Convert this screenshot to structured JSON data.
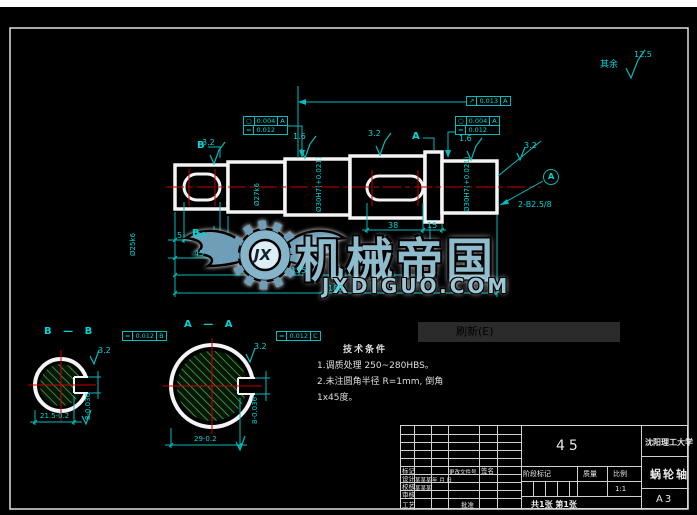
{
  "menu": {
    "refresh": "刷新(E)"
  },
  "watermark": {
    "brand": "机械帝国",
    "domain": "JXDIGUO.COM",
    "monogram": "JX"
  },
  "notes": {
    "title": "技术条件",
    "line1": "1.调质处理 250~280HBS。",
    "line2": "2.未注圆角半径 R=1mm, 倒角",
    "line3": "1x45度。"
  },
  "general_roughness": {
    "label": "其余",
    "value": "12.5"
  },
  "dims": {
    "rough_seg1": "3.2",
    "rough_seg3": "1.6",
    "rough_seg4": "3.2",
    "rough_seg5": "1.6",
    "rough_chamfer": "3.2",
    "dia_seg1": "Ø25k6",
    "dia_seg2": "Ø27k6",
    "dia_seg3": "Ø30H7(+0.021)",
    "dia_seg5": "Ø30H7(+0.021)",
    "len_5": "5",
    "len_28": "28",
    "len_45": "45",
    "len_38": "38",
    "len_15": "15",
    "len_155": "155",
    "len_188": "188",
    "center_holes": "2-B2.5/8",
    "cut_b_top": "B",
    "cut_b_bottom": "B",
    "cut_a_top": "A",
    "datum_a": "A"
  },
  "frames": {
    "f1_sym1": "○",
    "f1_val1": "0.004",
    "f1_ref1": "A",
    "f1_sym2": "=",
    "f1_val2": "0.012",
    "f2_sym": "↗",
    "f2_val": "0.013",
    "f2_ref": "A",
    "f3_sym1": "○",
    "f3_val1": "0.004",
    "f3_ref1": "A",
    "f3_sym2": "=",
    "f3_val2": "0.012",
    "fb_sym": "=",
    "fb_val": "0.012",
    "fb_ref": "B",
    "fc_sym": "=",
    "fc_val": "0.012",
    "fc_ref": "C"
  },
  "section_b": {
    "title": "B — B",
    "width": "21.5-0.2",
    "slot": "8-0.036",
    "rough": "3.2"
  },
  "section_a": {
    "title": "A — A",
    "width": "29-0.2",
    "slot": "8-0.036",
    "rough": "3.2"
  },
  "title_block": {
    "material": "45",
    "university": "沈阳理工大学",
    "part_name": "蜗轮轴",
    "paper": "A3",
    "stage": "阶段标记",
    "mass": "质量",
    "scale": "比例",
    "scale_val": "1:1",
    "sheets": "共1张 第1张",
    "r_mark": "标记",
    "r_change": "更改文件号",
    "r_sign": "签名",
    "r_design": "设计",
    "r_design_name": "某某某",
    "r_design_date": "年 月 日",
    "r_check": "校核",
    "r_check_name": "某某某",
    "r_review": "审核",
    "r_process": "工艺",
    "r_approve": "批准"
  }
}
